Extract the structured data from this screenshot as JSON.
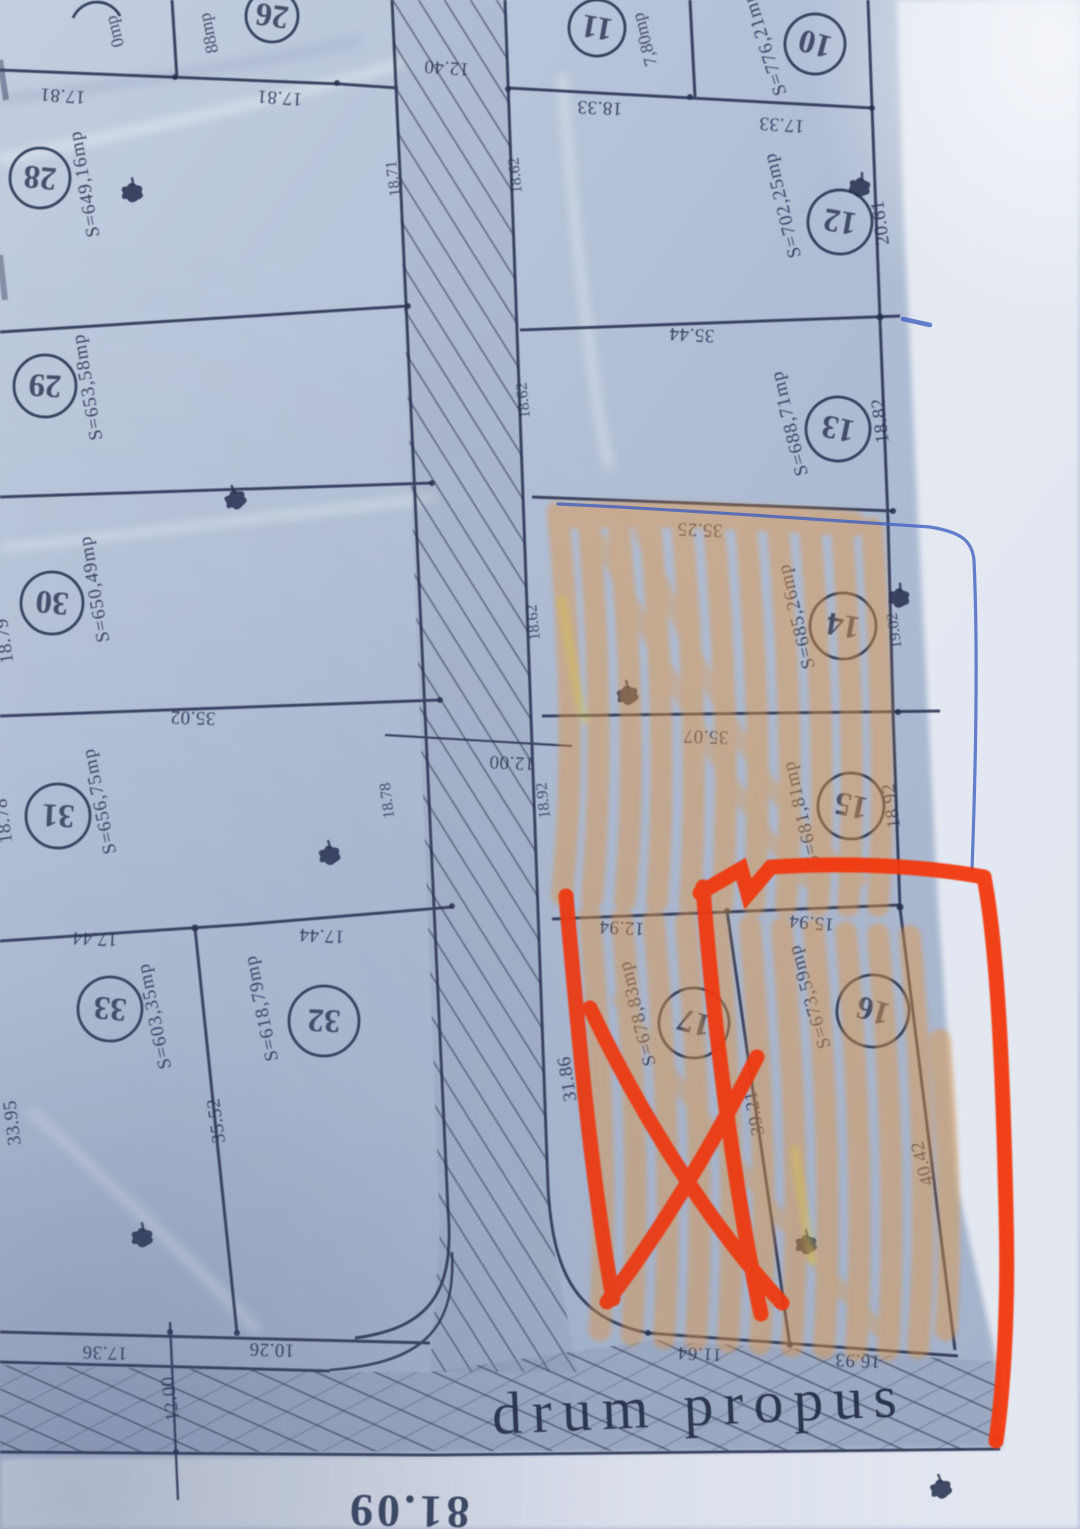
{
  "plan": {
    "road_label": "drum propus",
    "bottom_length": "81.09",
    "plots_left": {
      "p27": {
        "area_fragment": "0mp"
      },
      "p26": {
        "num": "26",
        "area_fragment": "88mp"
      },
      "p28": {
        "num": "28",
        "area": "S=649,16mp"
      },
      "p29": {
        "num": "29",
        "area": "S=653,58mp"
      },
      "p30": {
        "num": "30",
        "area": "S=650,49mp"
      },
      "p31": {
        "num": "31",
        "area": "S=656,75mp"
      },
      "p32": {
        "num": "32",
        "area": "S=618,79mp"
      },
      "p33": {
        "num": "33",
        "area": "S=603,35mp"
      }
    },
    "plots_right": {
      "p10": {
        "num": "10",
        "area": "S=776,21mp"
      },
      "p11": {
        "num": "11",
        "area_fragment": "7,80mp"
      },
      "p12": {
        "num": "12",
        "area": "S=702,25mp"
      },
      "p13": {
        "num": "13",
        "area": "S=688,71mp"
      },
      "p14": {
        "num": "14",
        "area": "S=685,26mp"
      },
      "p15": {
        "num": "15",
        "area": "S=681,81mp"
      },
      "p16": {
        "num": "16",
        "area": "S=673,59mp"
      },
      "p17": {
        "num": "17",
        "area": "S=678,83mp"
      }
    },
    "dims": {
      "front_26_l": "17.81",
      "front_26_r": "17.81",
      "d_11_12": "18.33",
      "d_10_12": "17.33",
      "d_12_13": "35.44",
      "d_12_right": "20.61",
      "d_13_14": "35.25",
      "d_13_right": "18.82",
      "d_14_15": "35.07",
      "d_14_right": "19.02",
      "d_15_right": "18.92",
      "d_15_17": "12.94",
      "d_15_16": "15.94",
      "d_16_17": "39.21",
      "d_16_right": "40.42",
      "d_17_left": "31.86",
      "d_17_front": "11.64",
      "d_16_front": "16.93",
      "d_30_31": "35.02",
      "d_30_left": "18.79",
      "d_31_left": "18.78",
      "d_31_row_l": "17.44",
      "d_31_row_r": "17.44",
      "d_32_33": "35.52",
      "d_33_left": "33.95",
      "d_33_front": "17.36",
      "d_33_front2": "10.26",
      "drum_w_left": "12.00",
      "road_w_top": "12.40",
      "road_w_mid": "12.00",
      "rf_12": "18.62",
      "rf_13": "18.62",
      "rf_14": "18.62",
      "rf_15": "18.92",
      "rf_31": "18.78",
      "rf_topleft": "18.71"
    },
    "colors": {
      "paper": "#b7c3d8",
      "ink": "#27304e",
      "highlight_orange": "#e2953f",
      "marker_red": "#f23711",
      "pen_blue": "#3d5fc0"
    },
    "symbols": {
      "tree": "bush-scribble",
      "road_fill": "diagonal-hatch"
    }
  }
}
